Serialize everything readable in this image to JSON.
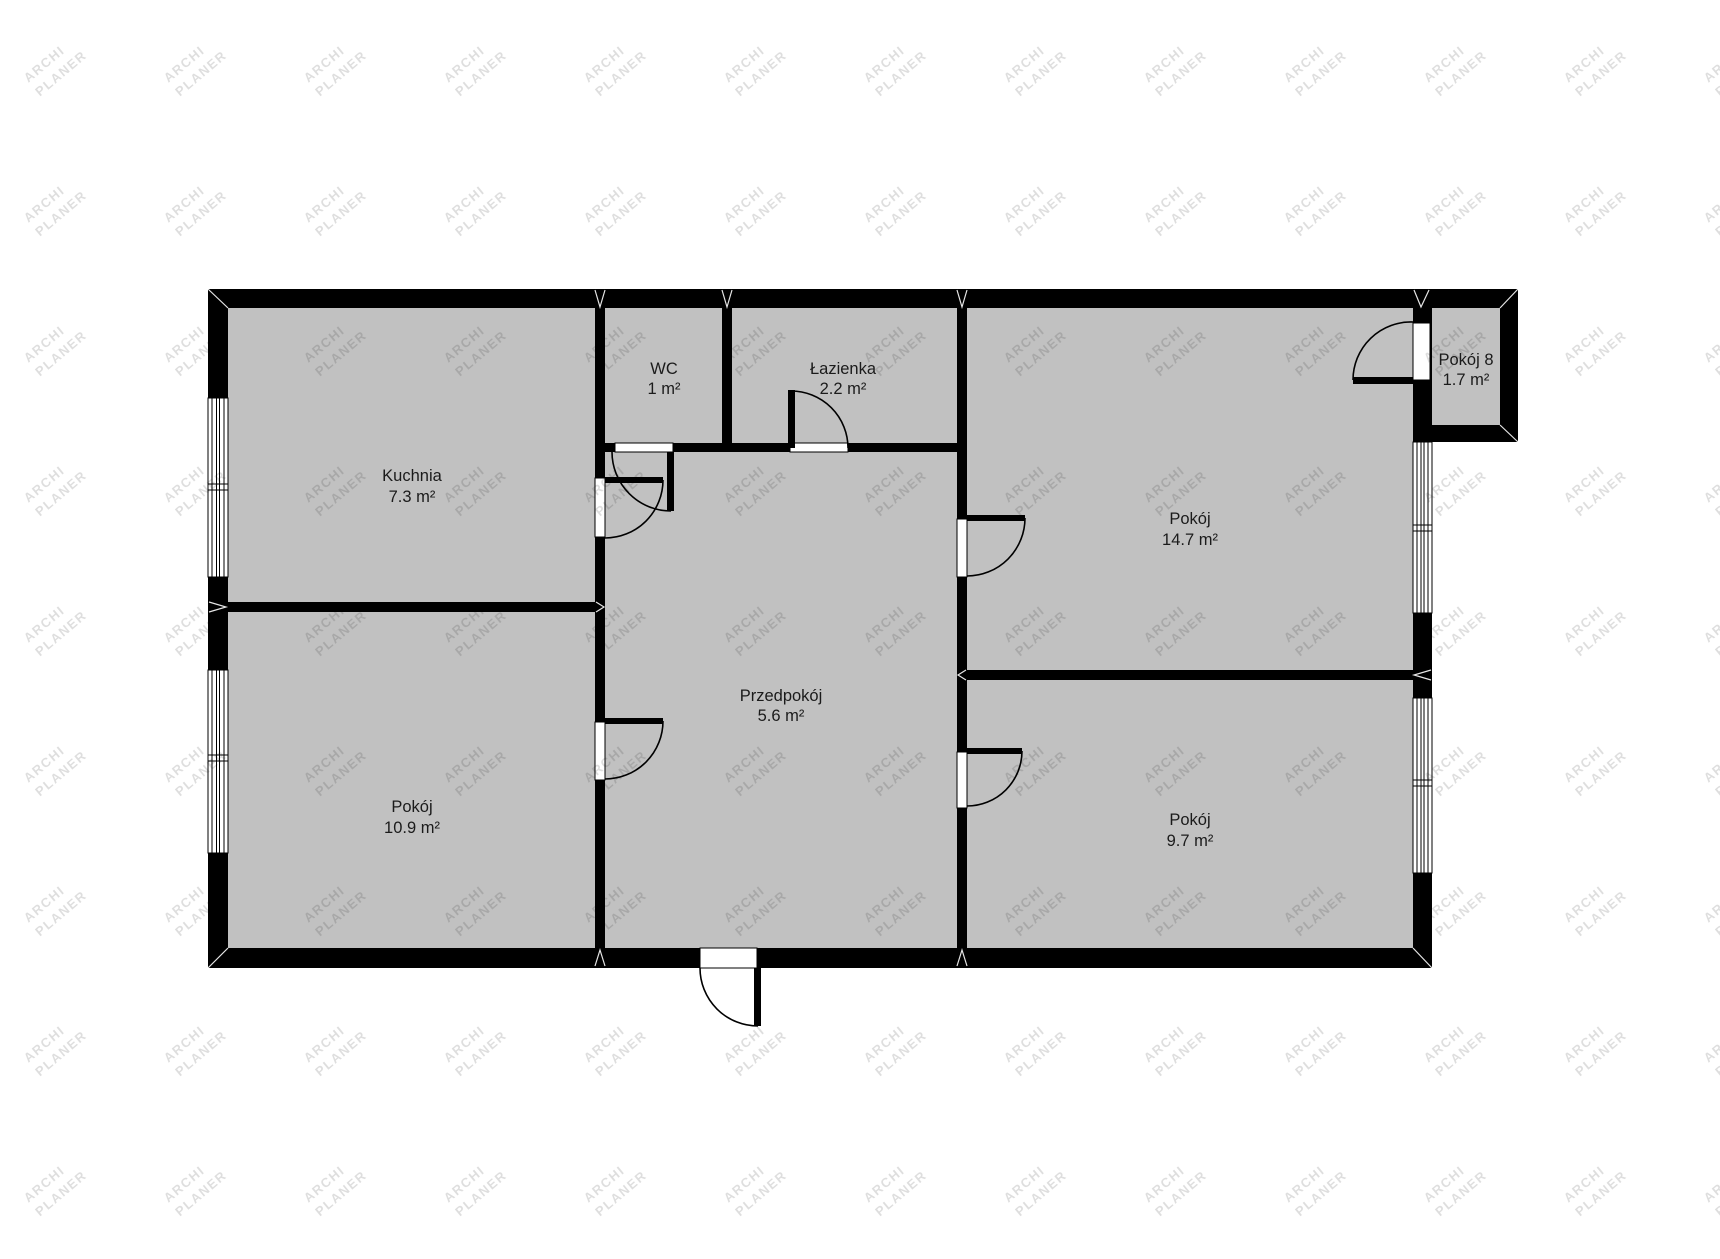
{
  "watermark": {
    "line1": "ARCHI",
    "line2": "PLANER"
  },
  "colors": {
    "floor": "#c1c1c1",
    "wall": "#000000",
    "background": "#ffffff",
    "label": "#1b1b1b"
  },
  "rooms": [
    {
      "id": "kuchnia",
      "name": "Kuchnia",
      "area": "7.3 m²"
    },
    {
      "id": "wc",
      "name": "WC",
      "area": "1 m²"
    },
    {
      "id": "lazienka",
      "name": "Łazienka",
      "area": "2.2 m²"
    },
    {
      "id": "pokoj-14-7",
      "name": "Pokój",
      "area": "14.7 m²"
    },
    {
      "id": "pokoj-8",
      "name": "Pokój 8",
      "area": "1.7 m²"
    },
    {
      "id": "przedpokoj",
      "name": "Przedpokój",
      "area": "5.6 m²"
    },
    {
      "id": "pokoj-10-9",
      "name": "Pokój",
      "area": "10.9 m²"
    },
    {
      "id": "pokoj-9-7",
      "name": "Pokój",
      "area": "9.7 m²"
    }
  ]
}
